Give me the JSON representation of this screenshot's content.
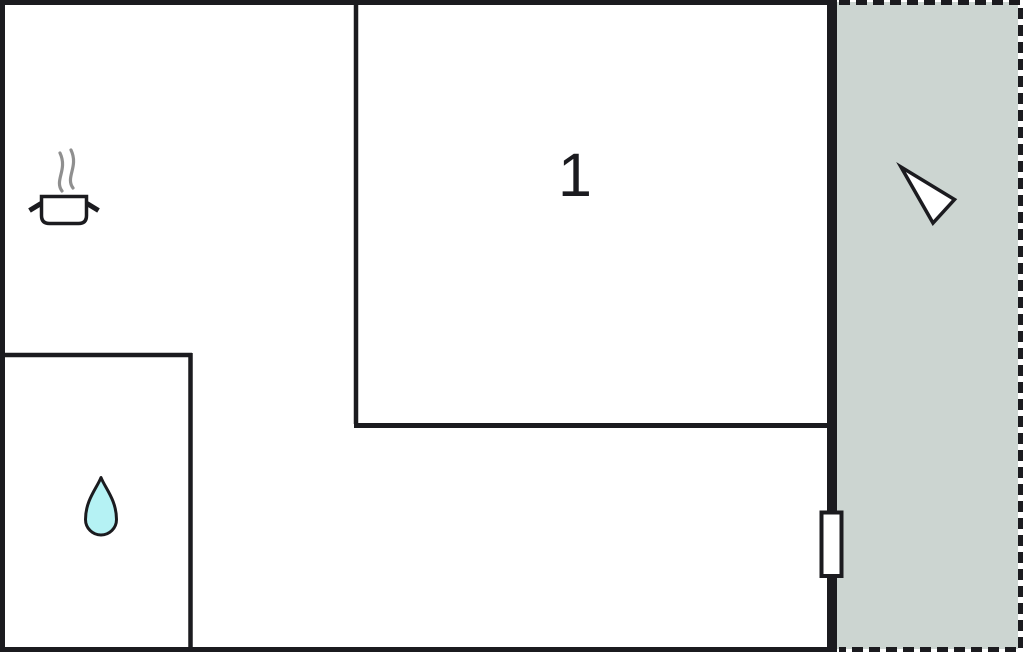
{
  "plan": {
    "room_label": "1",
    "rooms": [
      {
        "name": "kitchen-living-area",
        "icon": "cooking-pot-icon"
      },
      {
        "name": "room-1",
        "label": "1"
      },
      {
        "name": "bathroom",
        "icon": "water-drop-icon"
      },
      {
        "name": "terrace",
        "icon": "north-arrow-icon",
        "outline": "dashed"
      }
    ],
    "features": [
      {
        "name": "door",
        "position": "right-wall"
      }
    ]
  },
  "colors": {
    "wall": "#1b1b1f",
    "background": "#ffffff",
    "terrace_fill": "#ccd5d1",
    "water_drop_fill": "#b5f2f4",
    "steam": "#8f8f8f",
    "arrow_fill": "#ffffff",
    "door_fill": "#ffffff"
  }
}
